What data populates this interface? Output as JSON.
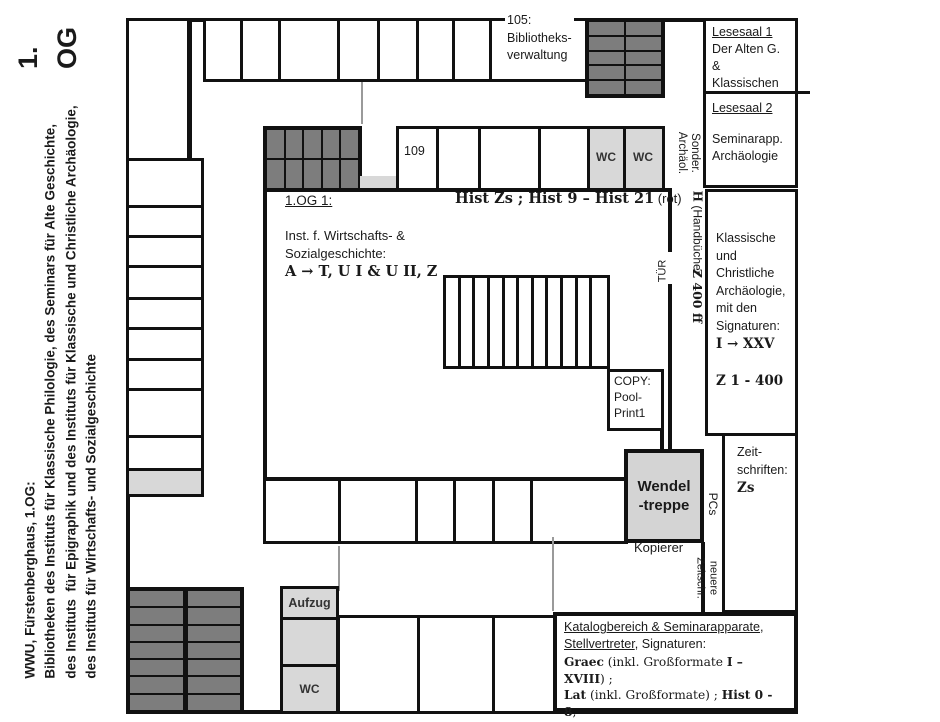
{
  "meta": {
    "floor_big": "1.\nOG"
  },
  "sidebar": {
    "caption": "WWU, Fürstenberghaus, 1.OG:\nBibliotheken des Instituts für Klassische Philologie, des Seminars für Alte Geschichte,\ndes Instituts  für Epigraphik und des Instituts für Klassische und Christliche Archäologie,\ndes Instituts für Wirtschafts- und Sozialgeschichte"
  },
  "rooms": {
    "verwaltung": "105:\nBibliotheks-\nverwaltung",
    "r109": "109",
    "wc_a": "WC",
    "wc_b": "WC",
    "aufzug": "Aufzug",
    "wc_c": "WC",
    "wendeltreppe": "Wendel\n-treppe",
    "kopierer": "Kopierer",
    "copy": "COPY:\nPool-\nPrint1"
  },
  "hall": {
    "title": "1.OG 1:",
    "sig_bold": "Hist Zs ; Hist 9 – Hist 21",
    "sig_note": " (rot)",
    "inst": "Inst. f. Wirtschafts- &\nSozialgeschichte:",
    "inst_sig": "A → T, U I & U II, Z"
  },
  "corridor": {
    "sonder": "Sonder.\nArchäol.",
    "hand_h": "H",
    "hand_rest": " (Handbücher",
    "z400": "Z 400 ff",
    "tuer": "TÜR",
    "pcs": "PCs",
    "neuere": "neuere\nZeitschr."
  },
  "right": {
    "lesesaal1_title": "Lesesaal 1",
    "lesesaal1_body": "Der Alten G. &\nKlassischen\nPhilologie",
    "lesesaal2_title": "Lesesaal 2",
    "lesesaal2_body": "Seminarapp.\nArchäologie",
    "klassische_body": "Klassische und\nChristliche\nArchäologie,\nmit den\nSignaturen:",
    "klassische_sig1": "I → XXV",
    "klassische_sig2": "Z 1 - 400",
    "zeitschriften_body": "Zeit-\nschriften:",
    "zeitschriften_sig": "Zs"
  },
  "katalog": {
    "l1_u": "Katalogbereich & Seminarapparate",
    "l1_r": ",",
    "l2_u": "Stellvertreter",
    "l2_r": ", Signaturen:",
    "l3_b1": "Graec",
    "l3_r1": " (inkl. Großformate ",
    "l3_b2": "I – XVIII",
    "l3_r2": ") ;",
    "l4_b1": "Lat",
    "l4_r1": " (inkl. Großformate) ; ",
    "l4_b2": "Hist 0 - 8",
    "l4_r2": ",",
    "l5_b": "Hist text ; I → XVIII ; Übersetzungen"
  },
  "colors": {
    "wall": "#111111",
    "dark_gray": "#7d7d7d",
    "light_gray": "#d8d8d8",
    "door_gray": "#9a9a9a"
  }
}
